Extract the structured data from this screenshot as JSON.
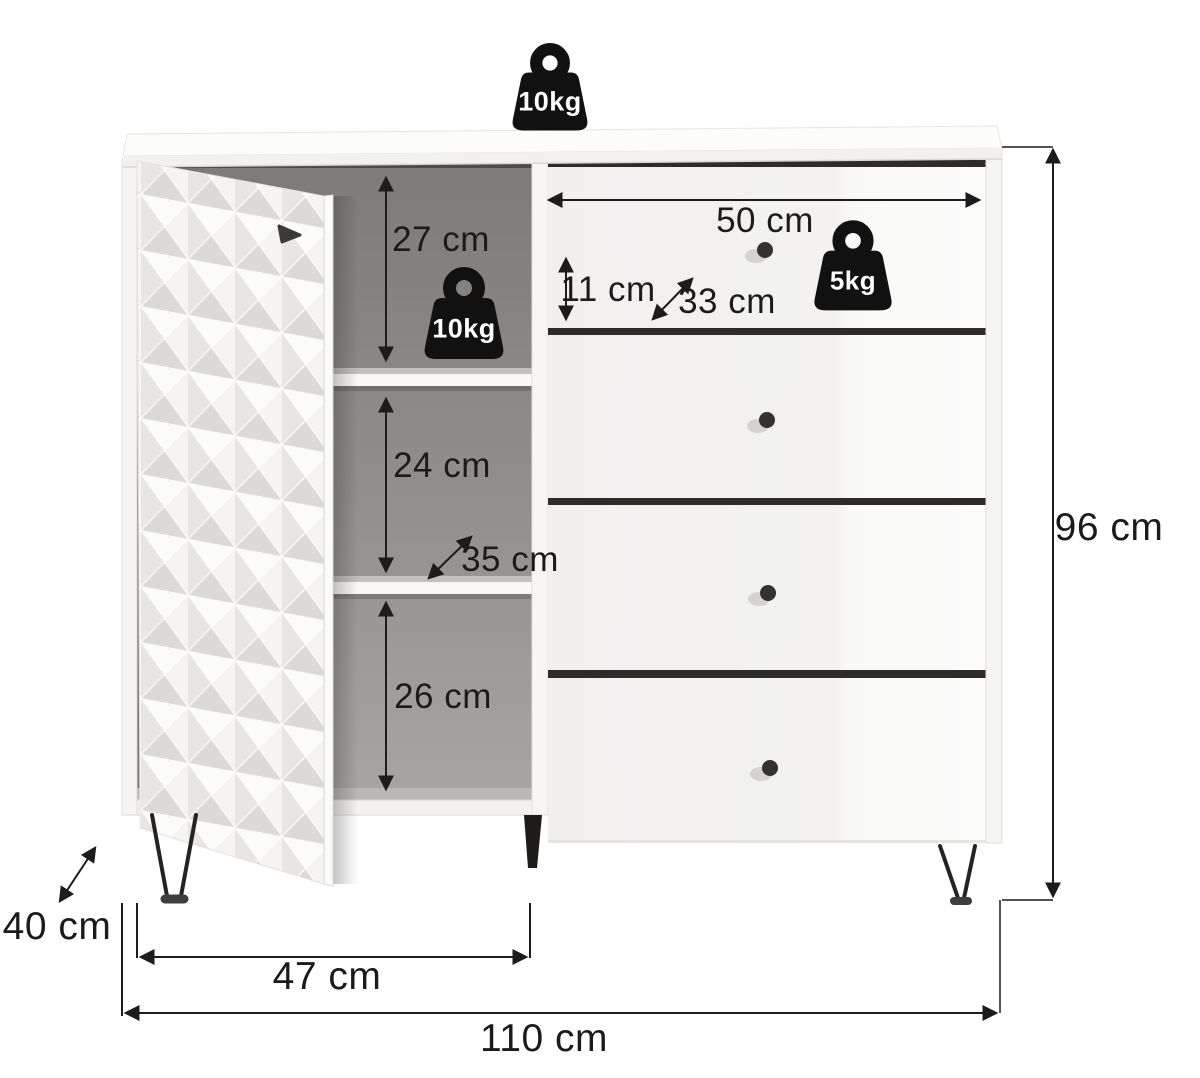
{
  "load_labels": {
    "top_surface": "10kg",
    "shelf": "10kg",
    "drawer": "5kg"
  },
  "dimension_labels": {
    "compartment_top": "27 cm",
    "compartment_middle": "24 cm",
    "compartment_bottom": "26 cm",
    "shelf_depth": "35 cm",
    "drawer_width": "50 cm",
    "drawer_height": "11 cm",
    "drawer_depth": "33 cm",
    "total_height": "96 cm",
    "total_depth": "40 cm",
    "door_section_width": "47 cm",
    "total_width": "110 cm"
  },
  "colors": {
    "dimension_line": "#1c1c1c",
    "weight_icon": "#111111",
    "interior_dark": "#7d7a77",
    "drawer_gap": "#2e2c2a"
  }
}
